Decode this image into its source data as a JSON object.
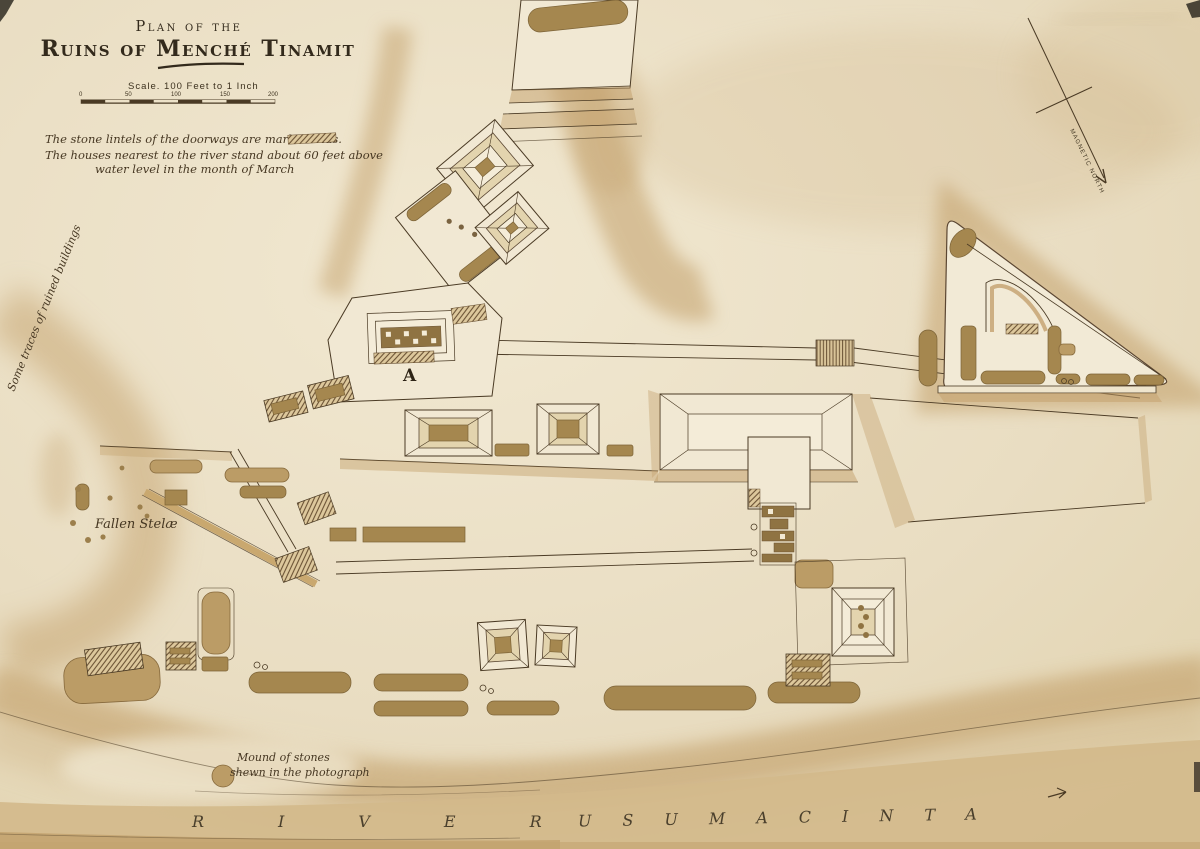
{
  "map": {
    "title_line1": "Plan of the",
    "title_line2": "Ruins of Menché Tinamit",
    "scale": {
      "label": "Scale. 100 Feet to 1 Inch",
      "ticks": [
        "0",
        "50",
        "100",
        "150",
        "200"
      ]
    },
    "notes": {
      "line1": "The stone lintels of the doorways are marked thus.",
      "line2": "The houses nearest to the river stand about 60 feet above",
      "line3": "water level in the month of March"
    },
    "labels": {
      "traces": "Some traces of ruined buildings",
      "fallen_stelae": "Fallen Stelæ",
      "structure_a": "A",
      "mound_line1": "Mound of stones",
      "mound_line2": "shewn in the photograph",
      "river_word1": "RIVER",
      "river_word2": "USUMACINTA",
      "compass": "MAGNETIC NORTH"
    },
    "colors": {
      "paper": "#e9ddc2",
      "slope": "#c3a06b",
      "mound": "#a5874f",
      "ink": "#4a3a24",
      "river": "#d3b98b"
    }
  }
}
